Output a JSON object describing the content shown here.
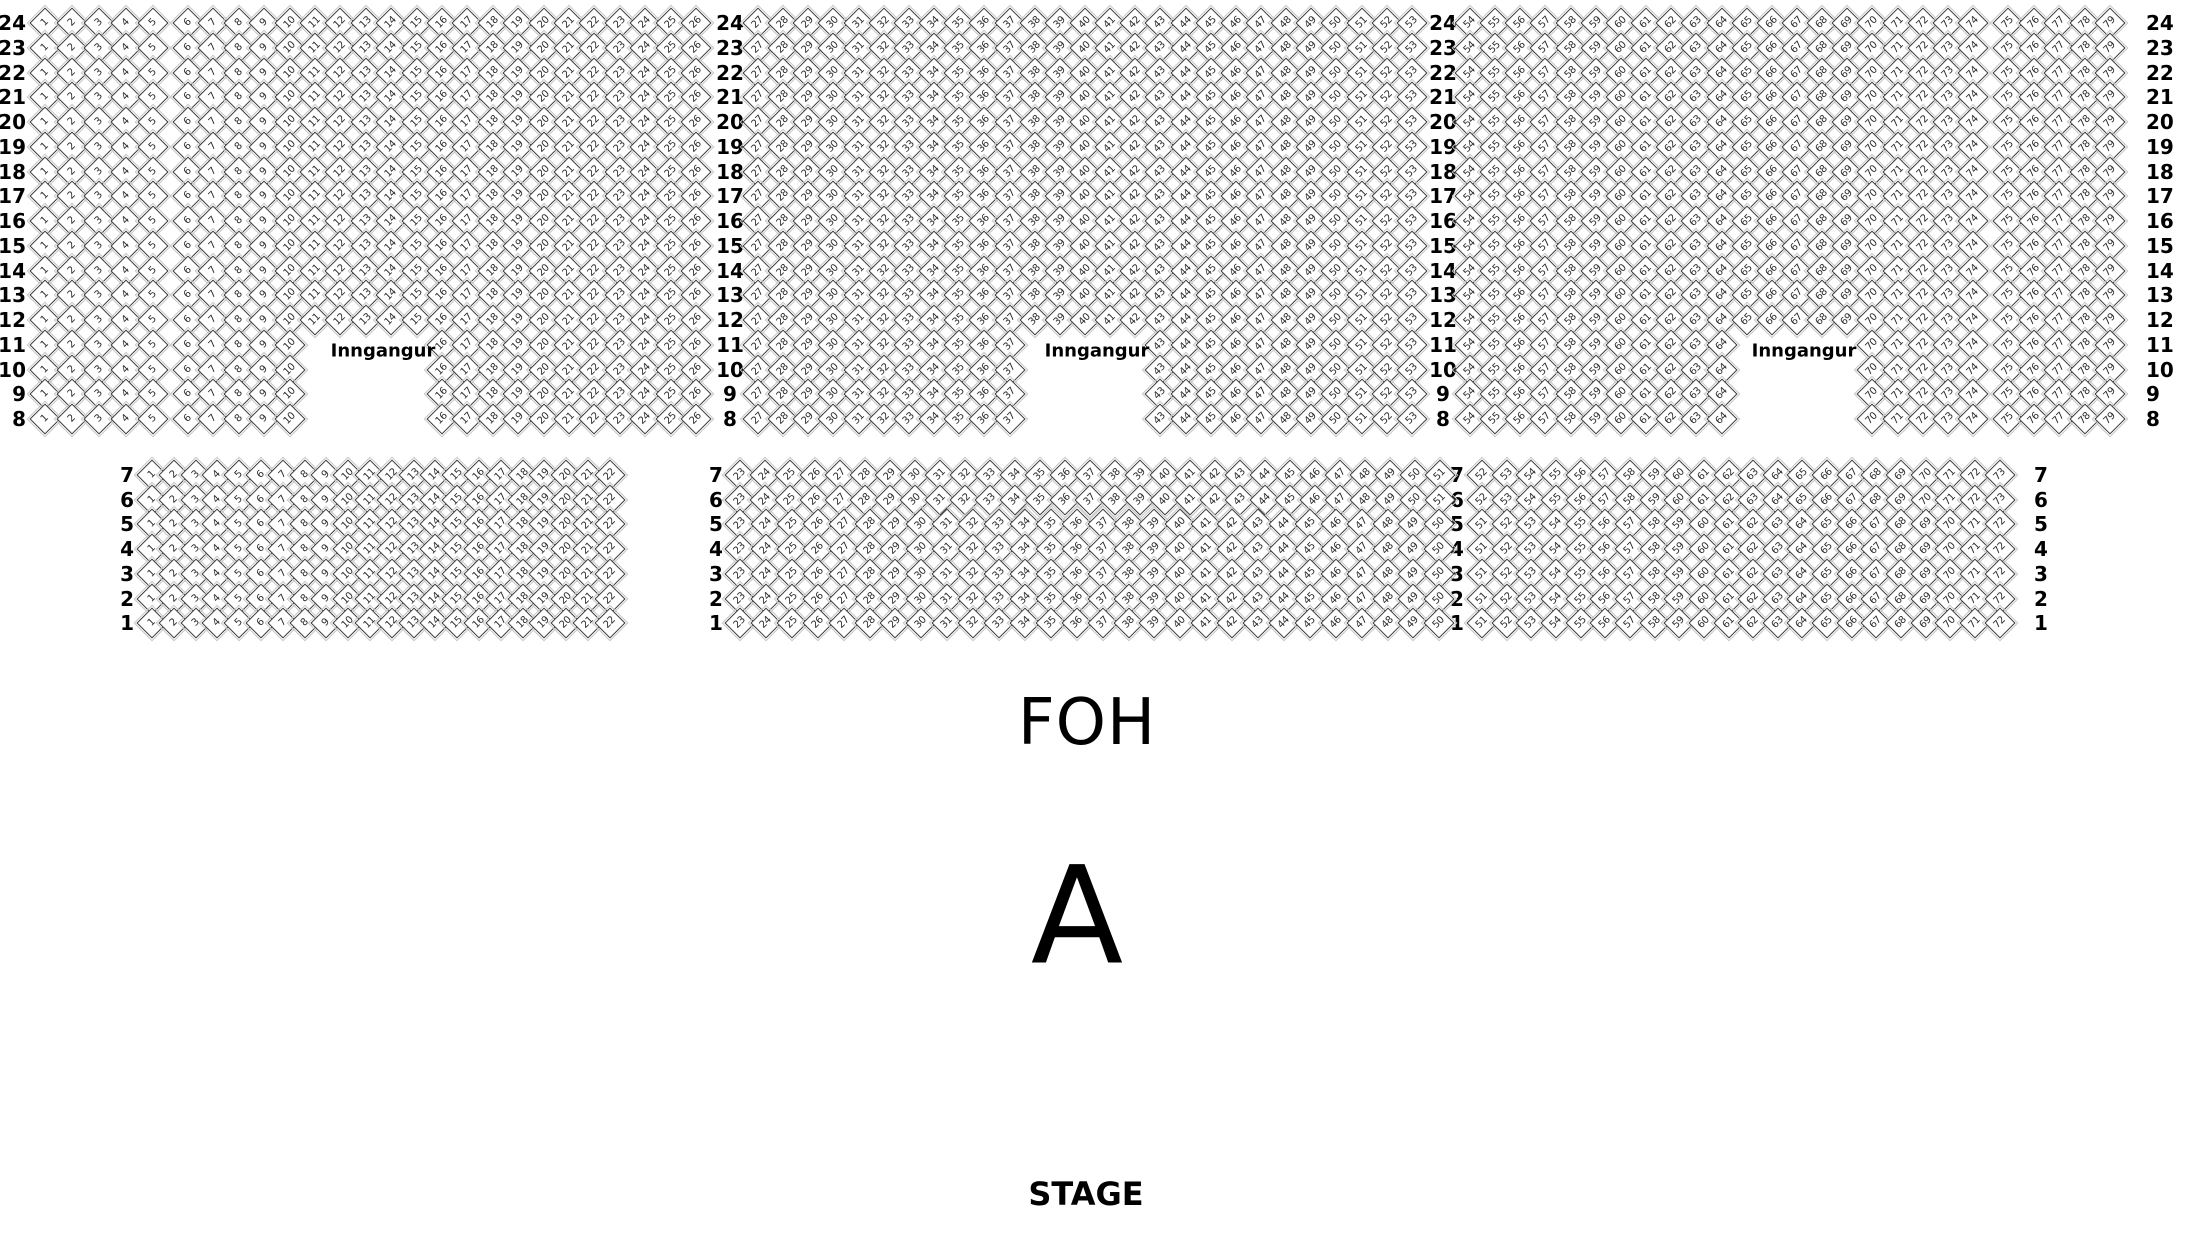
{
  "venue_map": {
    "entrance_label": "Inngangur",
    "colors": {
      "seat_fill": "#ffffff",
      "seat_border": "#3a3a3a",
      "seat_second_line": "#c6c6c6",
      "text": "#000000"
    }
  },
  "upper_section": {
    "rows_from": 24,
    "rows_to": 8,
    "y_start": 23,
    "row_pitch": 24.75,
    "row_label_columns": [
      {
        "x": 26,
        "align": "right"
      },
      {
        "x": 730,
        "align": "center"
      },
      {
        "x": 1443,
        "align": "center"
      },
      {
        "x": 2146,
        "align": "left"
      }
    ],
    "blocks": [
      {
        "id": "upper-left-aisle",
        "x_start": 45,
        "default": {
          "seat_from": 1,
          "seat_to": 5,
          "seat_pitch": 27
        }
      },
      {
        "id": "upper-main-left",
        "x_start": 188,
        "default": {
          "seat_from": 6,
          "seat_to": 26,
          "seat_pitch": 25.4
        },
        "entrance": {
          "seat_from": 11,
          "seat_to": 15,
          "row_from": 8,
          "row_to": 11,
          "label_x": 383,
          "label_y": 351
        }
      },
      {
        "id": "upper-main-center",
        "x_start": 758,
        "default": {
          "seat_from": 27,
          "seat_to": 53,
          "seat_pitch": 25.15
        },
        "entrance": {
          "seat_from": 38,
          "seat_to": 42,
          "row_from": 8,
          "row_to": 11,
          "label_x": 1097,
          "label_y": 351
        }
      },
      {
        "id": "upper-main-right",
        "x_start": 1470,
        "default": {
          "seat_from": 54,
          "seat_to": 74,
          "seat_pitch": 25.15
        },
        "entrance": {
          "seat_from": 65,
          "seat_to": 69,
          "row_from": 8,
          "row_to": 11,
          "label_x": 1804,
          "label_y": 351
        }
      },
      {
        "id": "upper-right-aisle",
        "x_start": 2008,
        "default": {
          "seat_from": 75,
          "seat_to": 79,
          "seat_pitch": 25.5
        }
      }
    ]
  },
  "lower_section": {
    "rows_from": 7,
    "rows_to": 1,
    "y_start": 475,
    "row_pitch": 24.7,
    "row_label_columns": [
      {
        "x": 134,
        "align": "right"
      },
      {
        "x": 716,
        "align": "center"
      },
      {
        "x": 1457,
        "align": "center"
      },
      {
        "x": 2034,
        "align": "left"
      }
    ],
    "blocks": [
      {
        "id": "lower-left",
        "x_start": 152,
        "default": {
          "seat_from": 1,
          "seat_to": 22,
          "seat_pitch": 21.8
        }
      },
      {
        "id": "lower-center",
        "x_start": 740,
        "default": {
          "seat_from": 23,
          "seat_to": 50,
          "seat_pitch": 25.9
        },
        "row_overrides": {
          "7": {
            "seat_from": 23,
            "seat_to": 51,
            "seat_pitch": 25.0
          },
          "6": {
            "seat_from": 23,
            "seat_to": 51,
            "seat_pitch": 25.0
          }
        }
      },
      {
        "id": "lower-right",
        "x_start": 1482,
        "default": {
          "seat_from": 51,
          "seat_to": 72,
          "seat_pitch": 24.65
        },
        "row_overrides": {
          "7": {
            "seat_from": 52,
            "seat_to": 73,
            "seat_pitch": 24.65
          },
          "6": {
            "seat_from": 52,
            "seat_to": 73,
            "seat_pitch": 24.65
          }
        }
      }
    ]
  },
  "labels": {
    "foh": {
      "text": "FOH",
      "x": 1087,
      "y": 723
    },
    "section_a": {
      "text": "A",
      "x": 1077,
      "y": 916
    },
    "stage": {
      "text": "STAGE",
      "x": 1086,
      "y": 1194
    }
  }
}
